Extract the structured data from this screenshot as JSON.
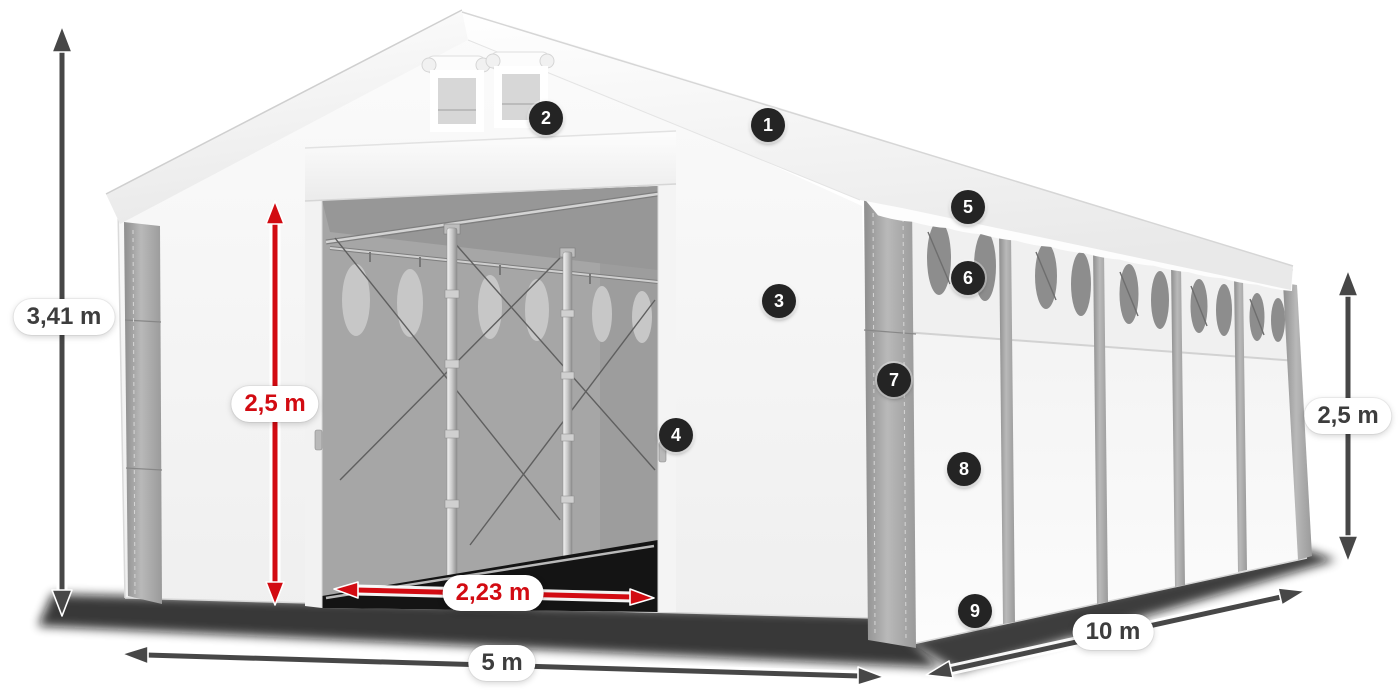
{
  "diagram": {
    "subject": "storage-tent-dimension-diagram",
    "dimensions": {
      "total_height": {
        "value": "3,41 m"
      },
      "door_height": {
        "value": "2,5 m"
      },
      "door_width": {
        "value": "2,23 m"
      },
      "front_width": {
        "value": "5 m"
      },
      "side_length": {
        "value": "10 m"
      },
      "side_height": {
        "value": "2,5 m"
      }
    },
    "markers": [
      {
        "number": "1"
      },
      {
        "number": "2"
      },
      {
        "number": "3"
      },
      {
        "number": "4"
      },
      {
        "number": "5"
      },
      {
        "number": "6"
      },
      {
        "number": "7"
      },
      {
        "number": "8"
      },
      {
        "number": "9"
      }
    ],
    "colors": {
      "accent_red": "#d20b12",
      "arrow_gray": "#474747",
      "badge_bg": "#242424",
      "label_text": "#3d3d3d"
    }
  }
}
